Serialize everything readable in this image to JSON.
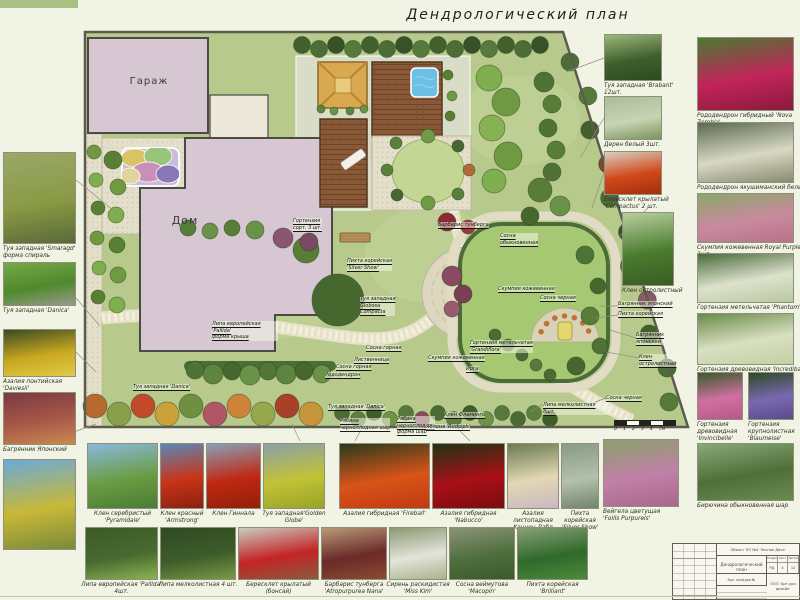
{
  "title": "Дендрологический план",
  "colors": {
    "background": "#f1f3e4",
    "lawn": "#b7ca8c",
    "building": "#d6c7d2",
    "deck_wood": "#8a5a38",
    "pool": "#6cc0e4",
    "path": "#e7e1ca",
    "hedge": "#4d6e38",
    "right_lawn": "#a6c873",
    "gazebo_roof": "#d9a94f"
  },
  "plan": {
    "garage_label": "Гараж",
    "house_label": "Дом",
    "labels": [
      {
        "text": "Гортензия\nсорт. 3 шт.",
        "x": 293,
        "y": 218
      },
      {
        "text": "Липа европейская 'Pallida'\nформа крыша",
        "x": 212,
        "y": 321
      },
      {
        "text": "Туя западная 'Danica'",
        "x": 133,
        "y": 384
      },
      {
        "text": "Пихта корейская\n'Silver Show'",
        "x": 347,
        "y": 258
      },
      {
        "text": "Туя западная\nGlobosa\nCompacta",
        "x": 360,
        "y": 296
      },
      {
        "text": "Сосна\nобыкновенная",
        "x": 500,
        "y": 233
      },
      {
        "text": "Скумпия кожевенная",
        "x": 498,
        "y": 286
      },
      {
        "text": "Сосна черная",
        "x": 540,
        "y": 295
      },
      {
        "text": "Барбарис тунберга",
        "x": 438,
        "y": 222
      },
      {
        "text": "Сосна горная",
        "x": 366,
        "y": 345
      },
      {
        "text": "Лиственница",
        "x": 354,
        "y": 357
      },
      {
        "text": "Сосна горная",
        "x": 336,
        "y": 364
      },
      {
        "text": "Рододендрон",
        "x": 325,
        "y": 372
      },
      {
        "text": "Туя западная 'Danica'",
        "x": 328,
        "y": 404
      },
      {
        "text": "Рябина\nчерноплодная шар",
        "x": 340,
        "y": 418
      },
      {
        "text": "Рябина\nчерноплодная\nформа шар",
        "x": 397,
        "y": 416
      },
      {
        "text": "Яблоня 'Rudolph'",
        "x": 426,
        "y": 424
      },
      {
        "text": "Клен Фламинго",
        "x": 444,
        "y": 412
      },
      {
        "text": "Скумпия кожевенная",
        "x": 428,
        "y": 355
      },
      {
        "text": "Гортензия метельчатая\n'Grandiflora'",
        "x": 470,
        "y": 340
      },
      {
        "text": "Ирга",
        "x": 466,
        "y": 366
      },
      {
        "text": "Багрянник японский",
        "x": 618,
        "y": 301
      },
      {
        "text": "Пихта корейская",
        "x": 618,
        "y": 311
      },
      {
        "text": "Багрянник\nяпонский",
        "x": 636,
        "y": 332
      },
      {
        "text": "Клен\nостролистный",
        "x": 639,
        "y": 354
      },
      {
        "text": "Сосна черная",
        "x": 606,
        "y": 395
      },
      {
        "text": "Липа мелколистная 8шт.",
        "x": 543,
        "y": 402
      }
    ]
  },
  "plants": {
    "left_column": [
      {
        "label": "Туя западная 'Smaragd'\nформа спираль",
        "x": 3,
        "y": 152,
        "w": 73,
        "h": 92,
        "g": [
          "#9aa86a",
          "#8a9a44",
          "#5a6a38"
        ]
      },
      {
        "label": "Туя западная 'Danica'",
        "x": 3,
        "y": 262,
        "w": 73,
        "h": 44,
        "g": [
          "#78a848",
          "#4e8a2c",
          "#9a9a8a"
        ]
      },
      {
        "label": "Азалия понтийская\n'Daviesii'",
        "x": 3,
        "y": 329,
        "w": 73,
        "h": 48,
        "g": [
          "#3a4a22",
          "#c8a820",
          "#e0cc48"
        ]
      },
      {
        "label": "Багрянник Японский",
        "x": 3,
        "y": 392,
        "w": 73,
        "h": 53,
        "g": [
          "#7a3a40",
          "#a85848",
          "#c88a50"
        ]
      },
      {
        "label": "",
        "x": 3,
        "y": 459,
        "w": 73,
        "h": 91,
        "g": [
          "#6aaad8",
          "#c8b838",
          "#7a8a3a"
        ]
      }
    ],
    "right_a": [
      {
        "label": "Туя западная 'Brabant' 12шт.",
        "x": 604,
        "y": 34,
        "w": 58,
        "h": 47,
        "g": [
          "#9ab87a",
          "#3f5e2c",
          "#2e4a22"
        ]
      },
      {
        "label": "Дерен белый 3шт.",
        "x": 604,
        "y": 96,
        "w": 58,
        "h": 44,
        "g": [
          "#aabb96",
          "#c8d4b4",
          "#7a945e"
        ]
      },
      {
        "label": "Бересклет крылатый\n'Compactus' 2 шт.",
        "x": 604,
        "y": 151,
        "w": 58,
        "h": 44,
        "g": [
          "#d8d0c0",
          "#d04818",
          "#a03010"
        ]
      },
      {
        "label": "Клен остролистный",
        "x": 622,
        "y": 212,
        "w": 52,
        "h": 74,
        "g": [
          "#b8cfa0",
          "#4a7c2e",
          "#3a5c24"
        ]
      },
      {
        "label": "Вейгела цветущая\n'Follis Purpureis'",
        "x": 603,
        "y": 439,
        "w": 76,
        "h": 68,
        "g": [
          "#8aa06a",
          "#c080a8",
          "#a86888"
        ]
      }
    ],
    "right_b": [
      {
        "label": "Рододендрон гибридный 'Nova Zembla'",
        "x": 697,
        "y": 37,
        "w": 97,
        "h": 74,
        "g": [
          "#4a7a30",
          "#c2245a",
          "#8a1a3e"
        ]
      },
      {
        "label": "Рододендрон якушиманский белый",
        "x": 697,
        "y": 122,
        "w": 97,
        "h": 61,
        "g": [
          "#5a6a4e",
          "#d8d8c4",
          "#8a8a72"
        ]
      },
      {
        "label": "Скумпия кожевенная Royal Purple 3шт.",
        "x": 697,
        "y": 193,
        "w": 97,
        "h": 50,
        "g": [
          "#8aa868",
          "#c88a9e",
          "#b87288"
        ]
      },
      {
        "label": "Гортензия метельчатая 'Phantom'",
        "x": 697,
        "y": 253,
        "w": 97,
        "h": 50,
        "g": [
          "#4a6a3a",
          "#dce2cc",
          "#b8c8a0"
        ]
      },
      {
        "label": "Гортензия древовидная 'Incrediball'",
        "x": 697,
        "y": 313,
        "w": 97,
        "h": 52,
        "g": [
          "#6a8a4a",
          "#d8e0c0",
          "#c2d0a2"
        ]
      },
      {
        "label": "Гортензия\nдревовидная\n'Invincibelle'",
        "x": 697,
        "y": 372,
        "w": 46,
        "h": 48,
        "g": [
          "#3a5a2c",
          "#d070a0",
          "#b85888"
        ]
      },
      {
        "label": "Гортензия\nкрупнолистная\n'Blaumeise'",
        "x": 748,
        "y": 372,
        "w": 46,
        "h": 48,
        "g": [
          "#2e4a24",
          "#7a68b0",
          "#5a4a8e"
        ]
      },
      {
        "label": "Бирючина обыкновенная шар",
        "x": 697,
        "y": 443,
        "w": 97,
        "h": 58,
        "g": [
          "#8aa87a",
          "#4e7038",
          "#6a8a50"
        ]
      }
    ],
    "bottom_row1": [
      {
        "label": "Клен серебристый 'Pyramidale'",
        "x": 87,
        "y": 443,
        "w": 71,
        "h": 66,
        "g": [
          "#8ab8dc",
          "#6a9c44",
          "#4a7c34"
        ]
      },
      {
        "label": "Клен красный\n'Armstrong'",
        "x": 160,
        "y": 443,
        "w": 44,
        "h": 66,
        "g": [
          "#5a88b8",
          "#c83418",
          "#8a2010"
        ]
      },
      {
        "label": "Клен Гиннала",
        "x": 206,
        "y": 443,
        "w": 55,
        "h": 66,
        "g": [
          "#88a0b8",
          "#c02812",
          "#902008"
        ]
      },
      {
        "label": "Туя западная'Golden Globe'",
        "x": 263,
        "y": 443,
        "w": 62,
        "h": 66,
        "g": [
          "#8aa0a8",
          "#c2c236",
          "#98a426"
        ]
      },
      {
        "label": "Азалия гибридная 'Fireball'",
        "x": 339,
        "y": 443,
        "w": 91,
        "h": 66,
        "g": [
          "#2a3a1c",
          "#d85418",
          "#c03a10"
        ]
      },
      {
        "label": "Азалия гибридная 'Nabucco'",
        "x": 432,
        "y": 443,
        "w": 73,
        "h": 66,
        "g": [
          "#1e3414",
          "#a81016",
          "#7a0c10"
        ]
      },
      {
        "label": "Азалия листопадная\nКэннон Дабл",
        "x": 507,
        "y": 443,
        "w": 52,
        "h": 66,
        "g": [
          "#6a7a52",
          "#e2d8b2",
          "#cab8c2"
        ]
      },
      {
        "label": "Пихта корейская\n'Silver Show'",
        "x": 561,
        "y": 443,
        "w": 38,
        "h": 66,
        "g": [
          "#8a9a84",
          "#b2c0ac",
          "#72846a"
        ]
      }
    ],
    "bottom_row2": [
      {
        "label": "Липа европейская 'Pallida' 4шт.",
        "x": 85,
        "y": 527,
        "w": 73,
        "h": 53,
        "g": [
          "#3c5a28",
          "#486a30",
          "#8ab450"
        ]
      },
      {
        "label": "Липа мелколистная 4 шт.",
        "x": 160,
        "y": 527,
        "w": 76,
        "h": 53,
        "g": [
          "#2f4a22",
          "#3d5c2a",
          "#7a9a44"
        ]
      },
      {
        "label": "Бересклет крылатый (бонсай)",
        "x": 238,
        "y": 527,
        "w": 81,
        "h": 53,
        "g": [
          "#c8ccc0",
          "#c42424",
          "#8a5a40"
        ]
      },
      {
        "label": "Барбарис тунберга\n'Atropurpurea Nana'",
        "x": 321,
        "y": 527,
        "w": 66,
        "h": 53,
        "g": [
          "#b89a78",
          "#6a2a28",
          "#8a4a34"
        ]
      },
      {
        "label": "Сирень раскидистая\n'Miss Kim'",
        "x": 389,
        "y": 527,
        "w": 58,
        "h": 53,
        "g": [
          "#8a9a72",
          "#e4e4da",
          "#a8b48c"
        ]
      },
      {
        "label": "Сосна веймутова 'Macopin'",
        "x": 449,
        "y": 527,
        "w": 66,
        "h": 53,
        "g": [
          "#8a9478",
          "#4e6e3c",
          "#3c5a2e"
        ]
      },
      {
        "label": "Пихта корейская 'Brilliant'",
        "x": 517,
        "y": 527,
        "w": 71,
        "h": 53,
        "g": [
          "#88a078",
          "#2f6a2a",
          "#4c8a3a"
        ]
      }
    ]
  },
  "scale_bar": {
    "text": "0 1 2 3 4 5м"
  },
  "stamp": {
    "project": "Объект ПО №4 'Лесная Дача'",
    "doc": "Дендрологический план",
    "cols": [
      "Стадия",
      "Лист",
      "Листов"
    ],
    "vals": [
      "РД",
      "4",
      "12"
    ],
    "row_label": "Арх. посадка №",
    "org": "ООО 'Арт-ури дизайн'"
  }
}
